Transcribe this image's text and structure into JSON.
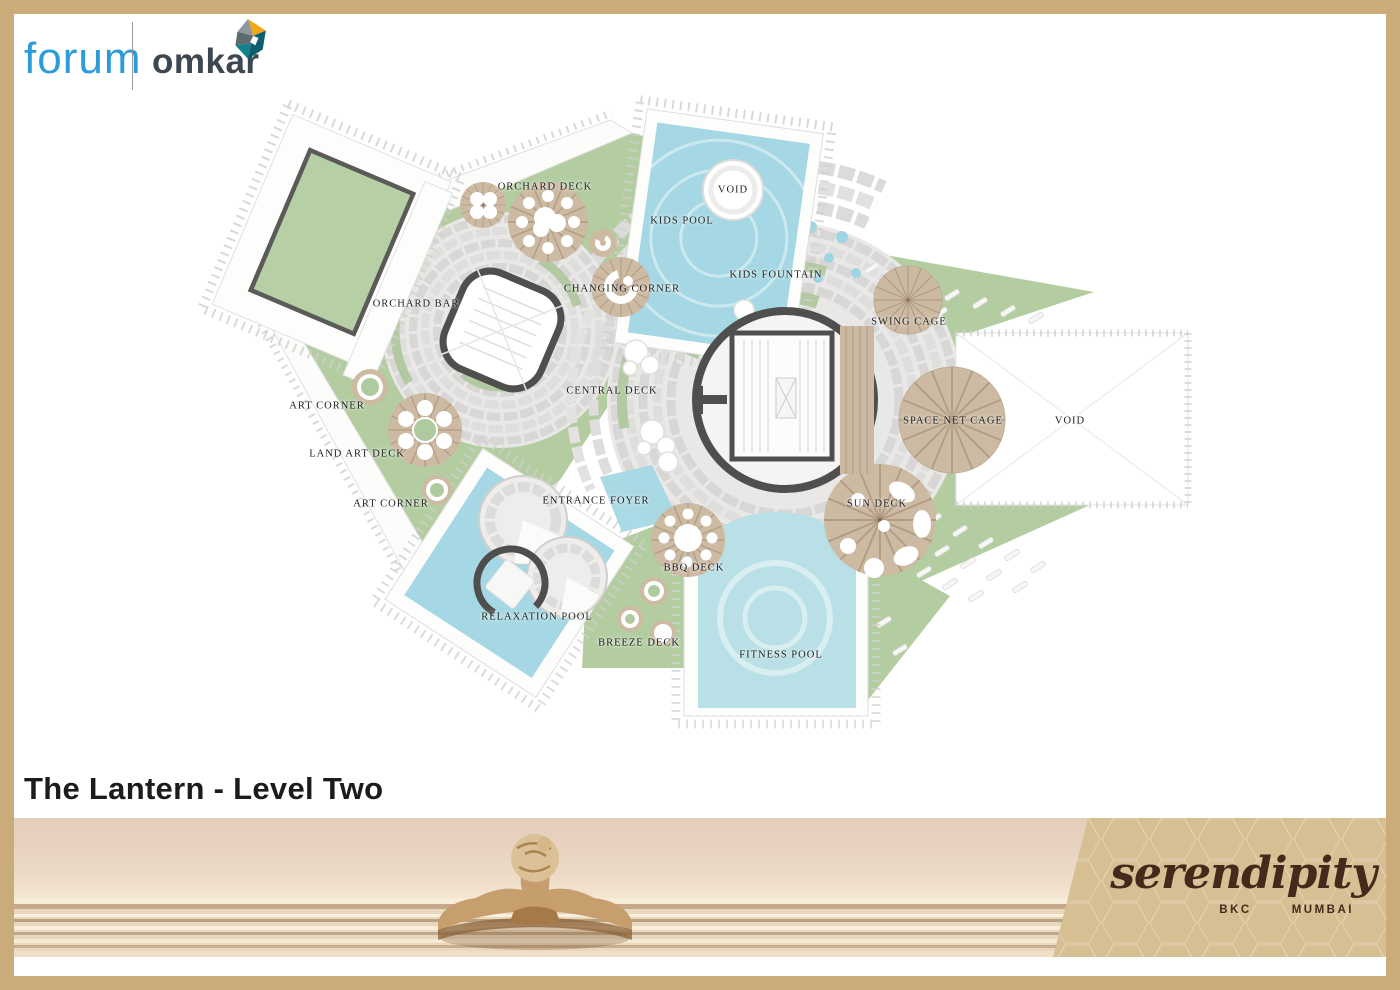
{
  "header": {
    "brand_primary": "forum",
    "brand_secondary": "omkar"
  },
  "title": "The Lantern - Level Two",
  "plan": {
    "labels": [
      {
        "id": "orchard-deck",
        "text": "ORCHARD DECK"
      },
      {
        "id": "kids-pool",
        "text": "KIDS POOL"
      },
      {
        "id": "void-pool",
        "text": "VOID"
      },
      {
        "id": "kids-fountain",
        "text": "KIDS FOUNTAIN"
      },
      {
        "id": "changing-corner",
        "text": "CHANGING CORNER"
      },
      {
        "id": "orchard-bar",
        "text": "ORCHARD BAR"
      },
      {
        "id": "swing-cage",
        "text": "SWING CAGE"
      },
      {
        "id": "art-corner-1",
        "text": "ART CORNER"
      },
      {
        "id": "central-deck",
        "text": "CENTRAL DECK"
      },
      {
        "id": "space-net-cage",
        "text": "SPACE NET CAGE"
      },
      {
        "id": "void-terrace",
        "text": "VOID"
      },
      {
        "id": "land-art-deck",
        "text": "LAND ART DECK"
      },
      {
        "id": "art-corner-2",
        "text": "ART CORNER"
      },
      {
        "id": "entrance-foyer",
        "text": "ENTRANCE FOYER"
      },
      {
        "id": "sun-deck",
        "text": "SUN DECK"
      },
      {
        "id": "bbq-deck",
        "text": "BBQ DECK"
      },
      {
        "id": "relaxation-pool",
        "text": "RELAXATION POOL"
      },
      {
        "id": "breeze-deck",
        "text": "BREEZE DECK"
      },
      {
        "id": "fitness-pool",
        "text": "FITNESS POOL"
      }
    ],
    "colors": {
      "water": "#a5d8e4",
      "lawn": "#b3cda1",
      "wood": "#cdbaa3",
      "paver": "#e9e8e6",
      "wall": "#4f4f4d",
      "frame": "#c9ac79"
    }
  },
  "footer": {
    "logo_text": "serendipity",
    "location_primary": "BKC",
    "location_secondary": "MUMBAI"
  }
}
